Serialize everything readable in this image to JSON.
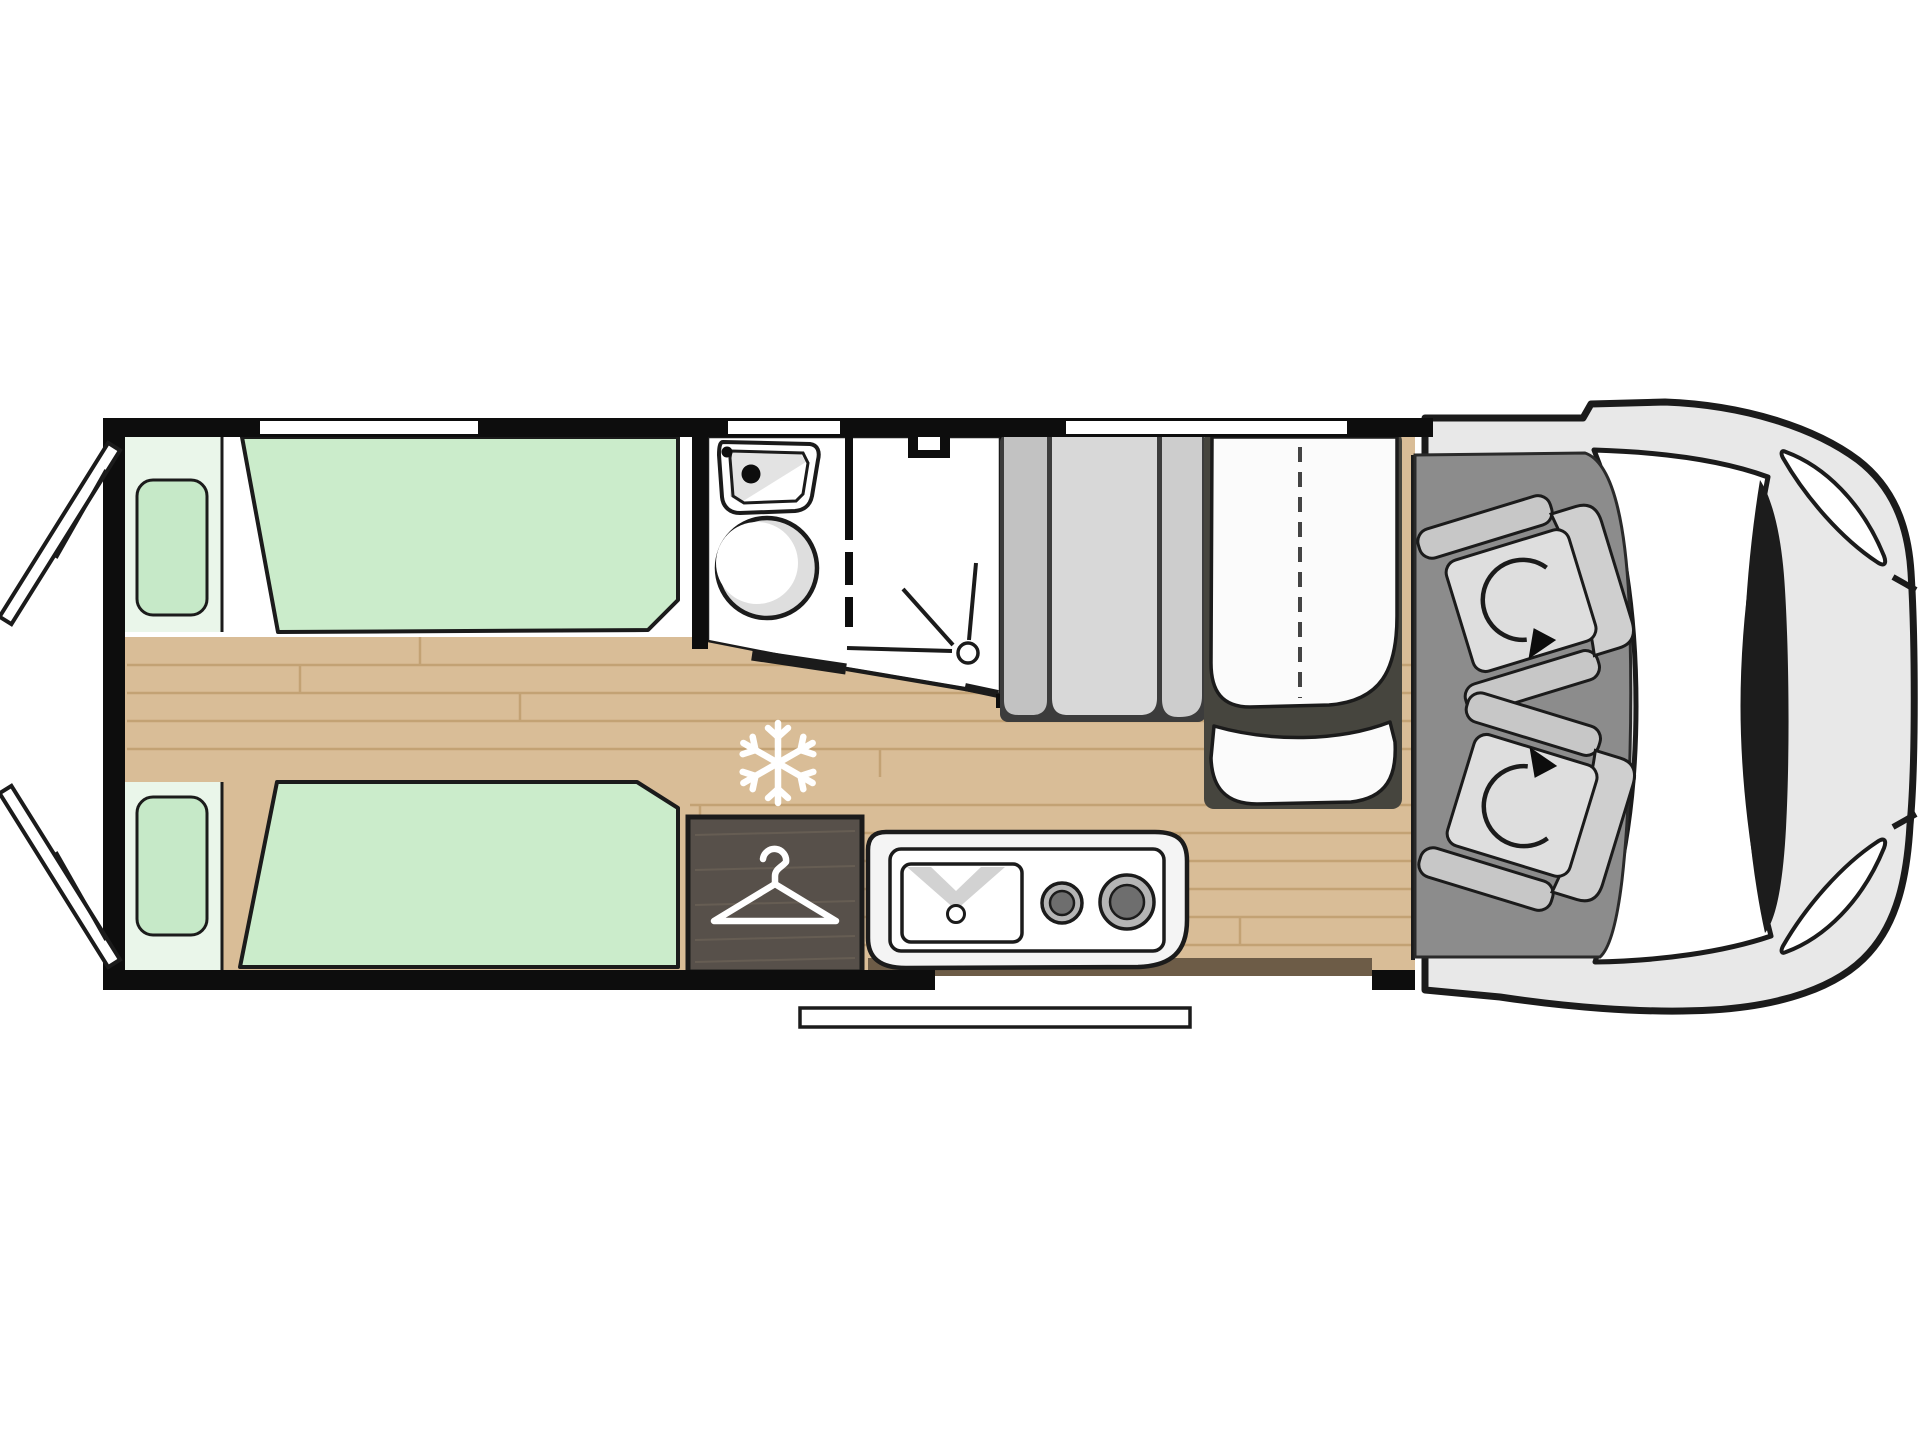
{
  "diagram": {
    "type": "motorhome-floorplan-top-view",
    "areas": [
      "rear-twin-beds",
      "corridor",
      "bathroom-washroom",
      "shower",
      "fridge-position",
      "wardrobe",
      "kitchen-block",
      "dinette-bench",
      "dinette-table",
      "side-bench",
      "entry-door-step",
      "cab-with-swivel-seats",
      "vehicle-front"
    ]
  },
  "icons": {
    "fridge": "snowflake-icon",
    "wardrobe": "clothes-hanger-icon",
    "swivel_seat": "rotation-arrow-icon",
    "shower": "shower-spray-icon",
    "kitchen": "sink-and-burners-icon",
    "bathroom": "washbasin-and-toilet-icon"
  },
  "colors": {
    "background": "#ffffff",
    "wall": "#0d0d0d",
    "interior": "#ffffff",
    "wood": "#d9bd97",
    "wood_line": "#c3a274",
    "wood_shadow": "#6d5c47",
    "bed": "#cbeccb",
    "pillow": "#c6e9c8",
    "pillow_zone": "#eaf6ea",
    "dark_outline": "#1b1b1b",
    "bath_fixture_shade": "#dedede",
    "wardrobe": "#57504a",
    "wardrobe_grain": "#6a6156",
    "kitchen_unit": "#f4f4f4",
    "burner_ring": "#b5b5b5",
    "burner_core": "#6e6e6e",
    "faucet": "#d2d2d2",
    "bench_backboard": "#3c3c3c",
    "bench_a": "#c2c2c2",
    "bench_b": "#d8d8d8",
    "bench_c": "#cdcdcd",
    "table_backboard": "#46453e",
    "table": "#fbfbfb",
    "cab_floor": "#8c8c8c",
    "seat_light": "#dedede",
    "seat_mid": "#cfcfcf",
    "seat_dark": "#c7c7c7",
    "van_body": "#e8e8e8",
    "glass": "#ffffff",
    "pillar": "#1c1c1c",
    "icon_white": "#ffffff"
  }
}
